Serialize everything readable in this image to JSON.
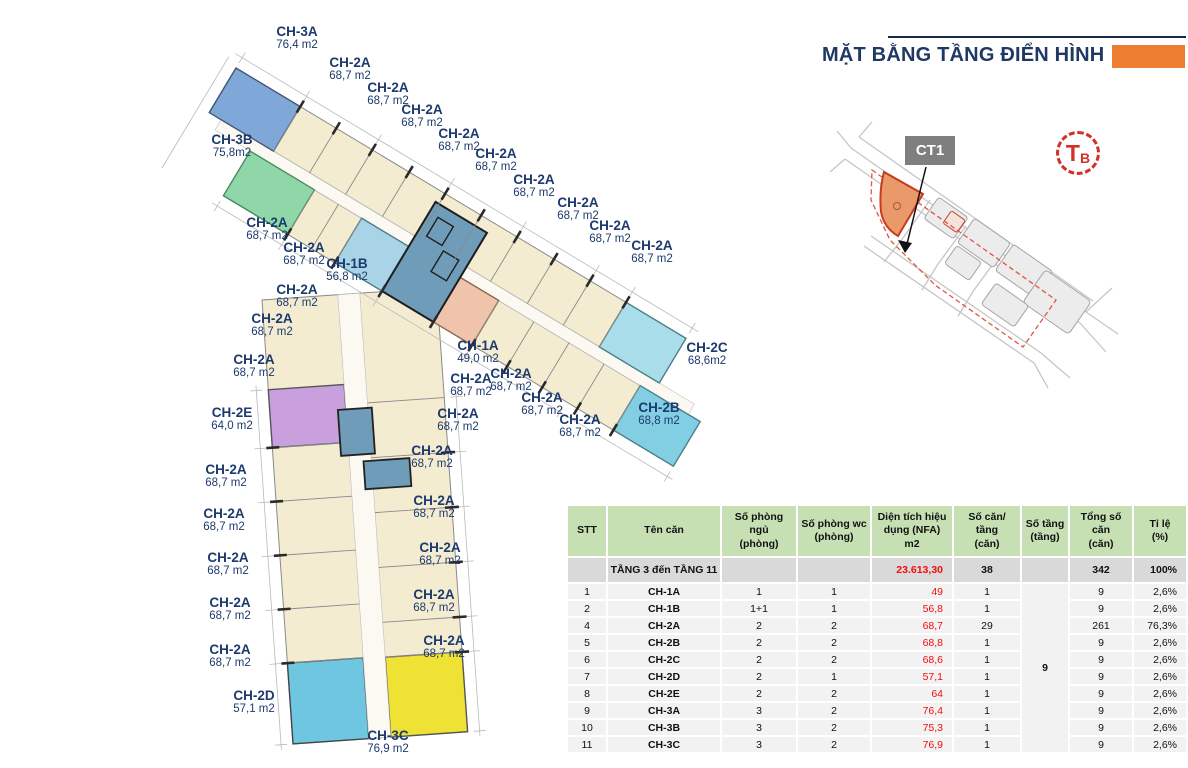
{
  "title": {
    "text": "MẶT BẰNG TẦNG ĐIỂN HÌNH"
  },
  "site_map": {
    "building_label": "CT1",
    "compass_main": "T",
    "compass_sub": "B"
  },
  "colors": {
    "title_navy": "#1f3864",
    "accent_orange": "#ed7d31",
    "label_navy": "#1c3a6e",
    "area_red": "#f20d0d",
    "compass_red": "#d3302a",
    "header_bg": "#c6e0b4",
    "summary_bg": "#d9d9d9",
    "row_bg": "#f2f2f2"
  },
  "unit_colors": {
    "CH-2A": "#f4ecd1",
    "CH-3A": "#7fa8d9",
    "CH-3B": "#8fd6a9",
    "CH-1B": "#a9d3e6",
    "CH-1A": "#efc4ab",
    "CH-2E": "#c9a0dd",
    "CH-2B": "#82cfe4",
    "CH-2C": "#a8dde9",
    "CH-2D": "#6ec6e0",
    "CH-3C": "#f0e135",
    "core": "#6f9cb8",
    "corridor": "#fbf9f1",
    "outline": "#8a8a8a",
    "wall": "#2a2a2a",
    "dim": "#b9b9b9"
  },
  "floorplan": {
    "labels": [
      {
        "name": "CH-3A",
        "area": "76,4 m2",
        "x": 297,
        "y": 24
      },
      {
        "name": "CH-2A",
        "area": "68,7 m2",
        "x": 350,
        "y": 55
      },
      {
        "name": "CH-2A",
        "area": "68,7 m2",
        "x": 388,
        "y": 80
      },
      {
        "name": "CH-2A",
        "area": "68,7 m2",
        "x": 422,
        "y": 102
      },
      {
        "name": "CH-2A",
        "area": "68,7 m2",
        "x": 459,
        "y": 126
      },
      {
        "name": "CH-2A",
        "area": "68,7 m2",
        "x": 496,
        "y": 146
      },
      {
        "name": "CH-2A",
        "area": "68,7 m2",
        "x": 534,
        "y": 172
      },
      {
        "name": "CH-2A",
        "area": "68,7 m2",
        "x": 578,
        "y": 195
      },
      {
        "name": "CH-2A",
        "area": "68,7 m2",
        "x": 610,
        "y": 218
      },
      {
        "name": "CH-2A",
        "area": "68,7 m2",
        "x": 652,
        "y": 238
      },
      {
        "name": "CH-3B",
        "area": "75,8m2",
        "x": 232,
        "y": 132
      },
      {
        "name": "CH-2A",
        "area": "68,7 m2",
        "x": 267,
        "y": 215
      },
      {
        "name": "CH-2A",
        "area": "68,7 m2",
        "x": 304,
        "y": 240
      },
      {
        "name": "CH-1B",
        "area": "56,8 m2",
        "x": 347,
        "y": 256
      },
      {
        "name": "CH-2A",
        "area": "68,7 m2",
        "x": 297,
        "y": 282
      },
      {
        "name": "CH-2A",
        "area": "68,7 m2",
        "x": 272,
        "y": 311
      },
      {
        "name": "CH-2A",
        "area": "68,7 m2",
        "x": 254,
        "y": 352
      },
      {
        "name": "CH-2E",
        "area": "64,0 m2",
        "x": 232,
        "y": 405
      },
      {
        "name": "CH-1A",
        "area": "49,0 m2",
        "x": 478,
        "y": 338
      },
      {
        "name": "CH-2A",
        "area": "68,7 m2",
        "x": 511,
        "y": 366
      },
      {
        "name": "CH-2A",
        "area": "68,7 m2",
        "x": 471,
        "y": 371
      },
      {
        "name": "CH-2A",
        "area": "68,7 m2",
        "x": 542,
        "y": 390
      },
      {
        "name": "CH-2A",
        "area": "68,7 m2",
        "x": 580,
        "y": 412
      },
      {
        "name": "CH-2B",
        "area": "68,8 m2",
        "x": 659,
        "y": 400
      },
      {
        "name": "CH-2C",
        "area": "68,6m2",
        "x": 707,
        "y": 340
      },
      {
        "name": "CH-2A",
        "area": "68,7 m2",
        "x": 458,
        "y": 406
      },
      {
        "name": "CH-2A",
        "area": "68,7 m2",
        "x": 432,
        "y": 443
      },
      {
        "name": "CH-2A",
        "area": "68,7 m2",
        "x": 226,
        "y": 462
      },
      {
        "name": "CH-2A",
        "area": "68,7 m2",
        "x": 434,
        "y": 493
      },
      {
        "name": "CH-2A",
        "area": "68,7 m2",
        "x": 224,
        "y": 506
      },
      {
        "name": "CH-2A",
        "area": "68,7 m2",
        "x": 440,
        "y": 540
      },
      {
        "name": "CH-2A",
        "area": "68,7 m2",
        "x": 228,
        "y": 550
      },
      {
        "name": "CH-2A",
        "area": "68,7 m2",
        "x": 434,
        "y": 587
      },
      {
        "name": "CH-2A",
        "area": "68,7 m2",
        "x": 230,
        "y": 595
      },
      {
        "name": "CH-2A",
        "area": "68,7 m2",
        "x": 444,
        "y": 633
      },
      {
        "name": "CH-2A",
        "area": "68,7 m2",
        "x": 230,
        "y": 642
      },
      {
        "name": "CH-2D",
        "area": "57,1 m2",
        "x": 254,
        "y": 688
      },
      {
        "name": "CH-3C",
        "area": "76,9 m2",
        "x": 388,
        "y": 728
      }
    ]
  },
  "table": {
    "headers": [
      "STT",
      "Tên căn",
      "Số phòng ngủ\n(phòng)",
      "Số phòng wc\n(phòng)",
      "Diện tích hiệu dụng (NFA)\nm2",
      "Số căn/ tầng\n(căn)",
      "Số tầng\n(tầng)",
      "Tổng số căn\n(căn)",
      "Tỉ lệ\n(%)"
    ],
    "summary": {
      "stt": "",
      "label": "TẦNG 3 đến TẦNG 11",
      "bedrooms": "",
      "wc": "",
      "area": "23.613,30",
      "per_floor": "38",
      "floors": "",
      "total": "342",
      "ratio": "100%"
    },
    "floors_merged": "9",
    "rows": [
      {
        "stt": "1",
        "name": "CH-1A",
        "bedrooms": "1",
        "wc": "1",
        "area": "49",
        "per_floor": "1",
        "total": "9",
        "ratio": "2,6%"
      },
      {
        "stt": "2",
        "name": "CH-1B",
        "bedrooms": "1+1",
        "wc": "1",
        "area": "56,8",
        "per_floor": "1",
        "total": "9",
        "ratio": "2,6%"
      },
      {
        "stt": "4",
        "name": "CH-2A",
        "bedrooms": "2",
        "wc": "2",
        "area": "68,7",
        "per_floor": "29",
        "total": "261",
        "ratio": "76,3%"
      },
      {
        "stt": "5",
        "name": "CH-2B",
        "bedrooms": "2",
        "wc": "2",
        "area": "68,8",
        "per_floor": "1",
        "total": "9",
        "ratio": "2,6%"
      },
      {
        "stt": "6",
        "name": "CH-2C",
        "bedrooms": "2",
        "wc": "2",
        "area": "68,6",
        "per_floor": "1",
        "total": "9",
        "ratio": "2,6%"
      },
      {
        "stt": "7",
        "name": "CH-2D",
        "bedrooms": "2",
        "wc": "1",
        "area": "57,1",
        "per_floor": "1",
        "total": "9",
        "ratio": "2,6%"
      },
      {
        "stt": "8",
        "name": "CH-2E",
        "bedrooms": "2",
        "wc": "2",
        "area": "64",
        "per_floor": "1",
        "total": "9",
        "ratio": "2,6%"
      },
      {
        "stt": "9",
        "name": "CH-3A",
        "bedrooms": "3",
        "wc": "2",
        "area": "76,4",
        "per_floor": "1",
        "total": "9",
        "ratio": "2,6%"
      },
      {
        "stt": "10",
        "name": "CH-3B",
        "bedrooms": "3",
        "wc": "2",
        "area": "75,3",
        "per_floor": "1",
        "total": "9",
        "ratio": "2,6%"
      },
      {
        "stt": "11",
        "name": "CH-3C",
        "bedrooms": "3",
        "wc": "2",
        "area": "76,9",
        "per_floor": "1",
        "total": "9",
        "ratio": "2,6%"
      }
    ]
  }
}
